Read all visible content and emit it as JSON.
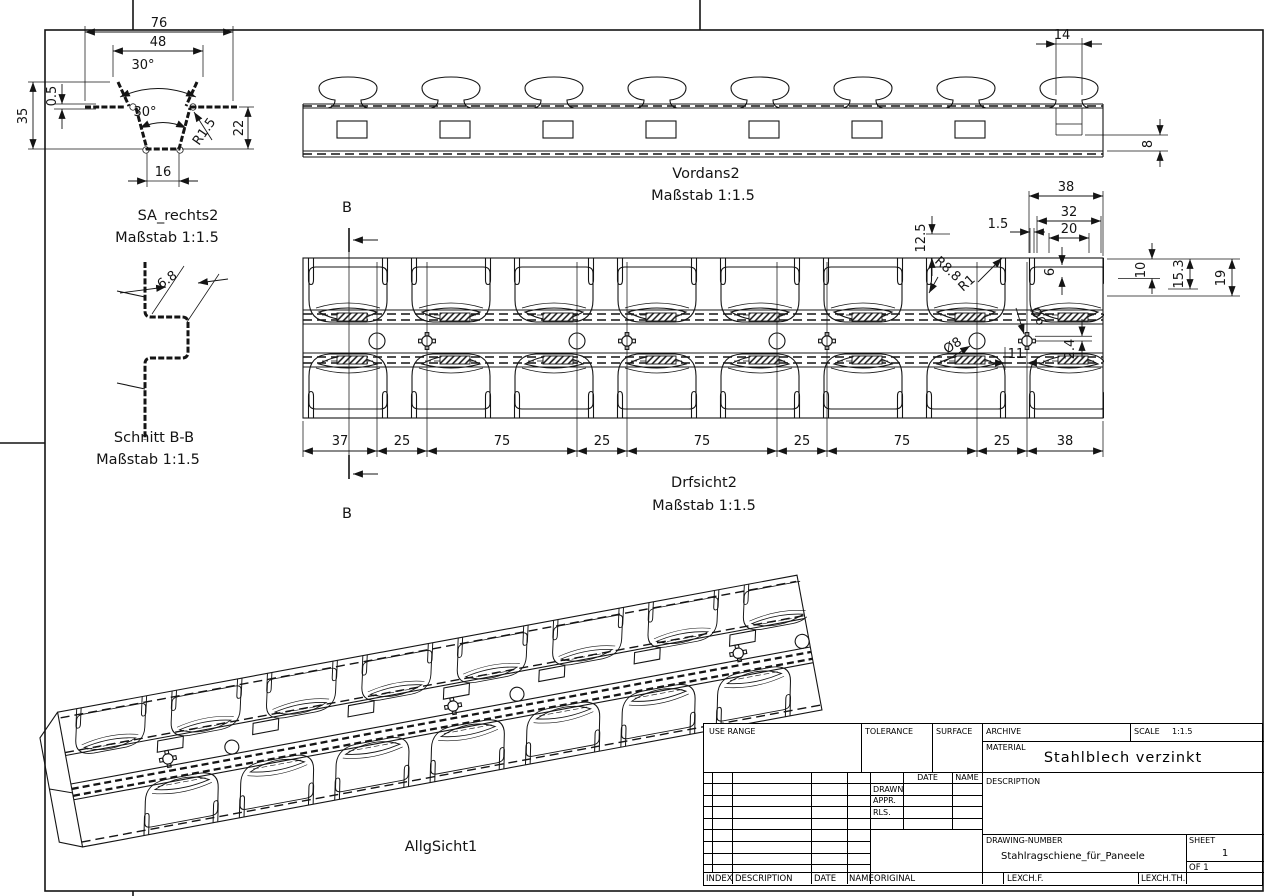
{
  "views": {
    "sa": {
      "title": "SA_rechts2",
      "scale": "Maßstab 1:1.5",
      "dim_76": "76",
      "dim_48": "48",
      "dim_angle_top": "30°",
      "dim_angle_bot": "30°",
      "dim_35": "35",
      "dim_05": "0.5",
      "dim_r15": "R1.5",
      "dim_22": "22",
      "dim_16": "16"
    },
    "vor": {
      "title": "Vordans2",
      "scale": "Maßstab 1:1.5",
      "dim_14": "14",
      "dim_8": "8"
    },
    "bb": {
      "title": "Schnitt B-B",
      "scale": "Maßstab 1:1.5",
      "dim_68": "6.8"
    },
    "drf": {
      "title": "Drfsicht2",
      "scale": "Maßstab 1:1.5",
      "section_letter": "B",
      "dim_38": "38",
      "dim_32": "32",
      "dim_20": "20",
      "dim_15": "1.5",
      "dim_125": "12.5",
      "dim_6": "6",
      "dim_10": "10",
      "dim_153": "15.3",
      "dim_19": "19",
      "dim_d8": "Ø8",
      "dim_d6": "Ø6",
      "dim_24": "2.4",
      "dim_11": "11",
      "dim_r88": "R8.8",
      "dim_r1": "R1",
      "pitch": [
        "37",
        "25",
        "75",
        "25",
        "75",
        "25",
        "75",
        "25",
        "38"
      ]
    },
    "iso": {
      "title": "AllgSicht1"
    }
  },
  "title_block": {
    "use_range": "USE RANGE",
    "tolerance": "TOLERANCE",
    "surface": "SURFACE",
    "archive": "ARCHIVE",
    "scale_label": "SCALE",
    "scale_value": "1:1.5",
    "material_label": "MATERIAL",
    "material_value": "Stahlblech verzinkt",
    "description_label": "DESCRIPTION",
    "date": "DATE",
    "name": "NAME",
    "drawn": "DRAWN",
    "appr": "APPR.",
    "rls": "RLS.",
    "drawing_number_label": "DRAWING-NUMBER",
    "drawing_number_value": "Stahlragschiene_für_Paneele",
    "sheet_label": "SHEET",
    "sheet_value": "1",
    "of_value": "OF 1",
    "index": "INDEX",
    "description2": "DESCRIPTION",
    "date2": "DATE",
    "name2": "NAME",
    "original": "ORIGINAL",
    "lexchf": "LEXCH.F.",
    "lexchth": "LEXCH.TH."
  }
}
